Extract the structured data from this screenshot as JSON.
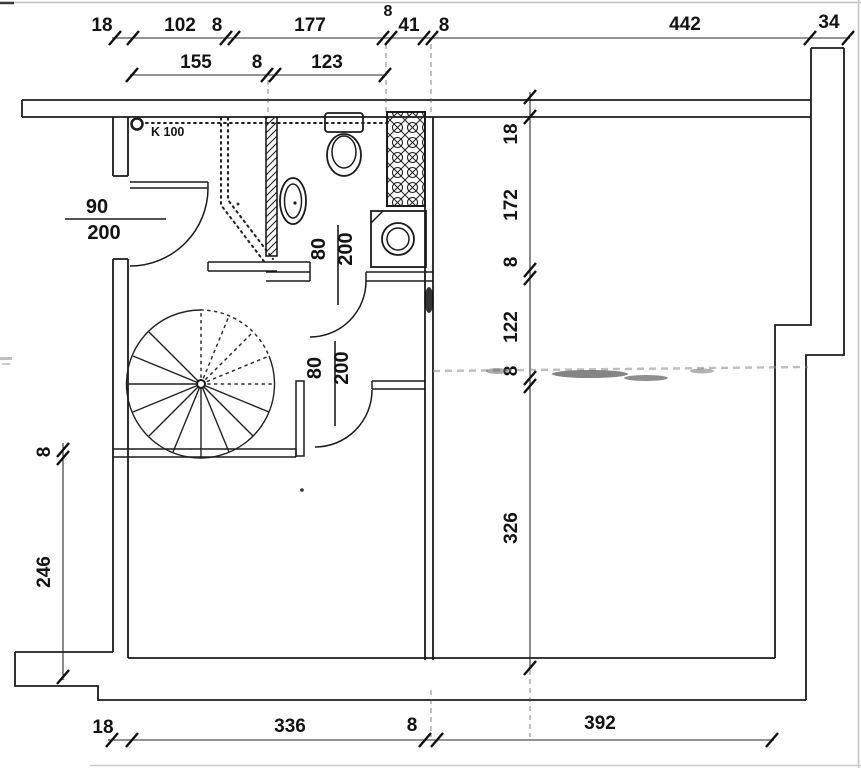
{
  "drawing": {
    "k100": "K 100",
    "doors": {
      "hall_num": "90",
      "hall_den": "200",
      "bath_num": "80",
      "bath_den": "200",
      "lower_num": "80",
      "lower_den": "200"
    },
    "dims": {
      "top1": [
        "18",
        "102",
        "8",
        "177",
        "8",
        "41",
        "8",
        "442",
        "34"
      ],
      "top2": [
        "155",
        "8",
        "123"
      ],
      "left": [
        "8",
        "246"
      ],
      "right": [
        "18",
        "172",
        "8",
        "122",
        "8",
        "326"
      ],
      "bottom": [
        "18",
        "336",
        "8",
        "392"
      ]
    },
    "colors": {
      "ink": "#1b1b1b",
      "paper": "#ffffff",
      "artifact": "#8a8a8a"
    }
  }
}
